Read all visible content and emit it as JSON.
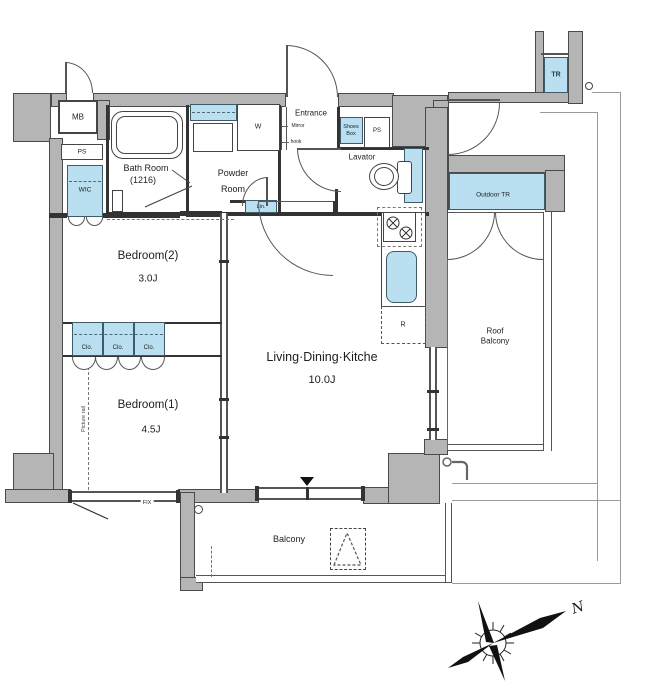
{
  "plan": {
    "rooms": {
      "bedroom2": {
        "name": "Bedroom(2)",
        "size": "3.0J"
      },
      "bedroom1": {
        "name": "Bedroom(1)",
        "size": "4.5J"
      },
      "ldk": {
        "name": "Living·Dining·Kitche",
        "size": "10.0J"
      },
      "bath": {
        "name": "Bath Room",
        "size": "(1216)"
      },
      "powder": {
        "line1": "Powder",
        "line2": "Room"
      },
      "lavator": "Lavator",
      "entrance": "Entrance",
      "balcony": "Balcony",
      "roof_balcony": {
        "line1": "Roof",
        "line2": "Balcony"
      },
      "wic": "WIC",
      "outdoor_tr": "Outdoor TR",
      "tr": "TR"
    },
    "fixtures": {
      "mb": "MB",
      "ps_left": "PS",
      "ps_right": "PS",
      "w": "W",
      "lin": "Lin.",
      "shoes_line1": "Shoes",
      "shoes_line2": "Box",
      "mirror": "Mirror",
      "hook": "hook",
      "r": "R",
      "fix": "FIX",
      "clo1": "Clo.",
      "clo2": "Clo.",
      "clo3": "Clo.",
      "picture_rail": "Picture rail"
    },
    "compass": {
      "north": "N"
    },
    "colors": {
      "wall_gray": "#b5b5b5",
      "fixture_blue": "#b9dff0",
      "line_dark": "#333333"
    }
  }
}
